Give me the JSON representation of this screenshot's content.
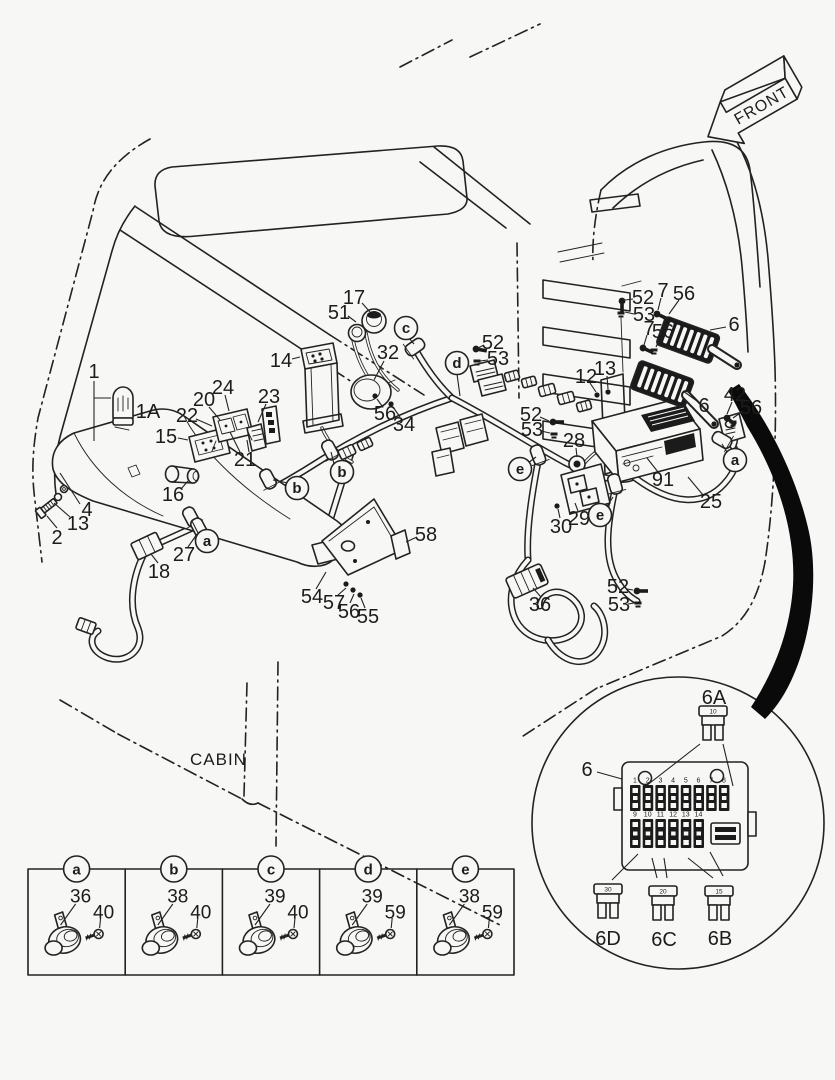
{
  "labels": {
    "front": "FRONT",
    "cabin": "CABIN"
  },
  "colors": {
    "line": "#222222",
    "background": "#f7f7f5",
    "swoosh": "#0a0a0a"
  },
  "callouts": [
    {
      "t": "1",
      "x": 94,
      "y": 372,
      "lead": [
        94,
        381,
        94,
        441
      ],
      "lead2": [
        94,
        398,
        111,
        398
      ]
    },
    {
      "t": "1A",
      "x": 148,
      "y": 412
    },
    {
      "t": "2",
      "x": 57,
      "y": 538,
      "lead": [
        57,
        528,
        47,
        516
      ]
    },
    {
      "t": "4",
      "x": 87,
      "y": 510,
      "lead": [
        80,
        504,
        60,
        473
      ]
    },
    {
      "t": "13",
      "x": 78,
      "y": 524,
      "lead": [
        70,
        517,
        54,
        503
      ]
    },
    {
      "t": "14",
      "x": 281,
      "y": 361,
      "lead": [
        292,
        359,
        300,
        357
      ]
    },
    {
      "t": "15",
      "x": 166,
      "y": 437,
      "lead": [
        178,
        438,
        188,
        440
      ]
    },
    {
      "t": "16",
      "x": 173,
      "y": 495,
      "lead": [
        181,
        489,
        188,
        481
      ]
    },
    {
      "t": "17",
      "x": 354,
      "y": 298,
      "lead": [
        362,
        303,
        370,
        312
      ]
    },
    {
      "t": "18",
      "x": 159,
      "y": 572,
      "lead": [
        158,
        563,
        151,
        554
      ]
    },
    {
      "t": "20",
      "x": 204,
      "y": 400,
      "lead": [
        209,
        407,
        220,
        420
      ]
    },
    {
      "t": "21",
      "x": 245,
      "y": 460,
      "lead": [
        240,
        452,
        230,
        432
      ],
      "lead2": [
        249,
        452,
        247,
        440
      ]
    },
    {
      "t": "22",
      "x": 187,
      "y": 416,
      "lead": [
        196,
        419,
        212,
        426
      ]
    },
    {
      "t": "23",
      "x": 269,
      "y": 397,
      "lead": [
        266,
        404,
        258,
        422
      ]
    },
    {
      "t": "24",
      "x": 223,
      "y": 388,
      "lead": [
        225,
        395,
        229,
        411
      ]
    },
    {
      "t": "25",
      "x": 711,
      "y": 502,
      "lead": [
        703,
        495,
        688,
        477
      ]
    },
    {
      "t": "27",
      "x": 184,
      "y": 555,
      "lead": [
        188,
        547,
        197,
        534
      ]
    },
    {
      "t": "28",
      "x": 574,
      "y": 441,
      "lead": [
        576,
        448,
        577,
        457
      ]
    },
    {
      "t": "29",
      "x": 579,
      "y": 519,
      "lead": [
        578,
        511,
        575,
        503
      ]
    },
    {
      "t": "30",
      "x": 561,
      "y": 527,
      "lead": [
        560,
        518,
        558,
        509
      ]
    },
    {
      "t": "32",
      "x": 388,
      "y": 353,
      "lead": [
        384,
        361,
        374,
        380
      ]
    },
    {
      "t": "34",
      "x": 404,
      "y": 425,
      "lead": [
        400,
        417,
        393,
        407
      ]
    },
    {
      "t": "36",
      "x": 540,
      "y": 605,
      "lead": [
        541,
        597,
        533,
        588
      ]
    },
    {
      "t": "42",
      "x": 735,
      "y": 395,
      "lead": [
        732,
        402,
        727,
        414
      ]
    },
    {
      "t": "51",
      "x": 339,
      "y": 313,
      "lead": [
        348,
        316,
        356,
        322
      ]
    },
    {
      "t": "52",
      "x": 643,
      "y": 298,
      "lead": [
        633,
        299,
        625,
        300
      ]
    },
    {
      "t": "53",
      "x": 644,
      "y": 315,
      "lead": [
        634,
        314,
        625,
        312
      ]
    },
    {
      "t": "7",
      "x": 663,
      "y": 291,
      "lead": [
        661,
        298,
        658,
        310
      ]
    },
    {
      "t": "56",
      "x": 684,
      "y": 294,
      "lead": [
        679,
        300,
        669,
        314
      ]
    },
    {
      "t": "7",
      "x": 649,
      "y": 329,
      "lead": [
        647,
        335,
        644,
        345
      ]
    },
    {
      "t": "56",
      "x": 663,
      "y": 332,
      "lead": [
        660,
        338,
        656,
        347
      ]
    },
    {
      "t": "6",
      "x": 734,
      "y": 325,
      "lead": [
        726,
        327,
        710,
        330
      ]
    },
    {
      "t": "6",
      "x": 704,
      "y": 406,
      "lead": [
        697,
        401,
        683,
        391
      ]
    },
    {
      "t": "12",
      "x": 586,
      "y": 377,
      "lead": [
        590,
        383,
        596,
        392
      ]
    },
    {
      "t": "13",
      "x": 605,
      "y": 369,
      "lead": [
        607,
        376,
        608,
        389
      ]
    },
    {
      "t": "52",
      "x": 493,
      "y": 343,
      "lead": [
        484,
        345,
        478,
        348
      ]
    },
    {
      "t": "53",
      "x": 498,
      "y": 359,
      "lead": [
        488,
        360,
        480,
        361
      ]
    },
    {
      "t": "52",
      "x": 531,
      "y": 415,
      "lead": [
        540,
        417,
        549,
        421
      ]
    },
    {
      "t": "53",
      "x": 532,
      "y": 430,
      "lead": [
        541,
        431,
        550,
        433
      ]
    },
    {
      "t": "52",
      "x": 618,
      "y": 587,
      "lead": [
        627,
        589,
        633,
        590
      ]
    },
    {
      "t": "53",
      "x": 619,
      "y": 605,
      "lead": [
        628,
        604,
        634,
        603
      ]
    },
    {
      "t": "54",
      "x": 312,
      "y": 597,
      "lead": [
        316,
        589,
        326,
        572
      ]
    },
    {
      "t": "55",
      "x": 368,
      "y": 617,
      "lead": [
        365,
        608,
        361,
        598
      ]
    },
    {
      "t": "56",
      "x": 349,
      "y": 612,
      "lead": [
        350,
        603,
        354,
        594
      ]
    },
    {
      "t": "57",
      "x": 334,
      "y": 603,
      "lead": [
        338,
        595,
        346,
        588
      ]
    },
    {
      "t": "58",
      "x": 426,
      "y": 535,
      "lead": [
        417,
        537,
        406,
        542
      ]
    },
    {
      "t": "56",
      "x": 385,
      "y": 414,
      "lead": [
        382,
        406,
        377,
        399
      ]
    },
    {
      "t": "56",
      "x": 751,
      "y": 408,
      "lead": [
        743,
        411,
        733,
        418
      ]
    },
    {
      "t": "91",
      "x": 663,
      "y": 480,
      "lead": [
        658,
        472,
        647,
        458
      ]
    },
    {
      "t": "6",
      "x": 587,
      "y": 770,
      "lead": [
        597,
        772,
        622,
        779
      ]
    },
    {
      "t": "6A",
      "x": 714,
      "y": 698
    },
    {
      "t": "6D",
      "x": 608,
      "y": 939
    },
    {
      "t": "6C",
      "x": 664,
      "y": 940
    },
    {
      "t": "6B",
      "x": 720,
      "y": 939
    }
  ],
  "circled": [
    {
      "t": "a",
      "x": 207,
      "y": 541,
      "lead": [
        198,
        533,
        192,
        521
      ]
    },
    {
      "t": "a",
      "x": 735,
      "y": 460,
      "lead": [
        727,
        452,
        722,
        444
      ]
    },
    {
      "t": "b",
      "x": 297,
      "y": 488,
      "lead": [
        288,
        483,
        273,
        480
      ]
    },
    {
      "t": "b",
      "x": 342,
      "y": 472,
      "lead": [
        334,
        464,
        331,
        452
      ]
    },
    {
      "t": "c",
      "x": 406,
      "y": 328,
      "lead": [
        409,
        338,
        414,
        344
      ]
    },
    {
      "t": "d",
      "x": 457,
      "y": 363,
      "lead": [
        457,
        374,
        460,
        396
      ]
    },
    {
      "t": "e",
      "x": 520,
      "y": 469,
      "lead": [
        528,
        463,
        536,
        457
      ]
    },
    {
      "t": "e",
      "x": 600,
      "y": 515,
      "lead": [
        606,
        508,
        613,
        497
      ]
    }
  ],
  "detail": {
    "panel_label": "6",
    "fuse_top": {
      "label": "6A",
      "amp": "10"
    },
    "fuses_bottom": [
      {
        "label": "6D",
        "amp": "30"
      },
      {
        "label": "6C",
        "amp": "20"
      },
      {
        "label": "6B",
        "amp": "15"
      }
    ],
    "slots_top": [
      "1",
      "2",
      "3",
      "4",
      "5",
      "6",
      "7",
      "8"
    ],
    "slots_bottom": [
      "9",
      "10",
      "11",
      "12",
      "13",
      "14"
    ]
  },
  "legend": {
    "cells": [
      {
        "letter": "a",
        "part": "36",
        "bolt": "40"
      },
      {
        "letter": "b",
        "part": "38",
        "bolt": "40"
      },
      {
        "letter": "c",
        "part": "39",
        "bolt": "40"
      },
      {
        "letter": "d",
        "part": "39",
        "bolt": "59"
      },
      {
        "letter": "e",
        "part": "38",
        "bolt": "59"
      }
    ]
  }
}
